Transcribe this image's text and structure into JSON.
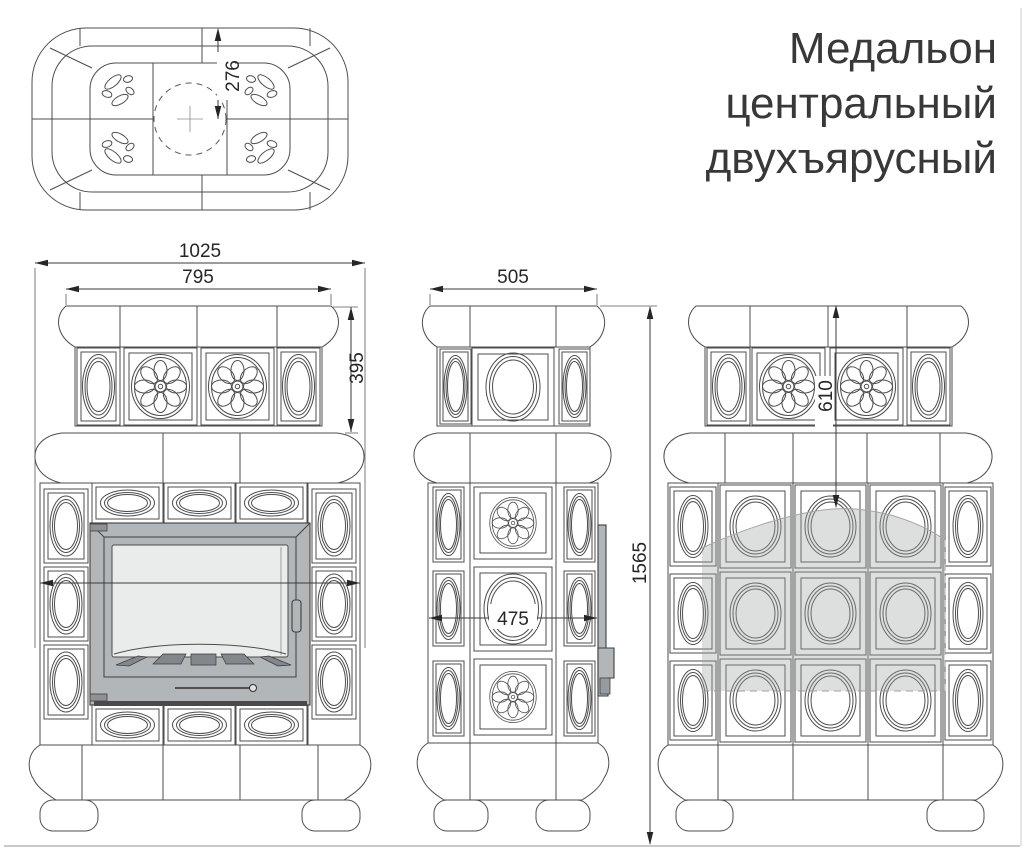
{
  "title": {
    "line1": "Медальон",
    "line2": "центральный",
    "line3": "двухъярусный"
  },
  "dimensions": {
    "flue_center_offset": "276",
    "overall_width": "1025",
    "crown_width": "795",
    "upper_tier_height": "395",
    "side_width": "505",
    "overall_height": "1565",
    "side_body_width": "475",
    "upper_section_height": "610"
  },
  "colors": {
    "line": "#4d4d4d",
    "dimension": "#262626",
    "metal_gray": "#b3b6b8",
    "glass_gray": "#eaeceb",
    "vent_gray": "#83868a",
    "shade_gray": "#dcdedd",
    "ground": "#c7c9c9"
  }
}
